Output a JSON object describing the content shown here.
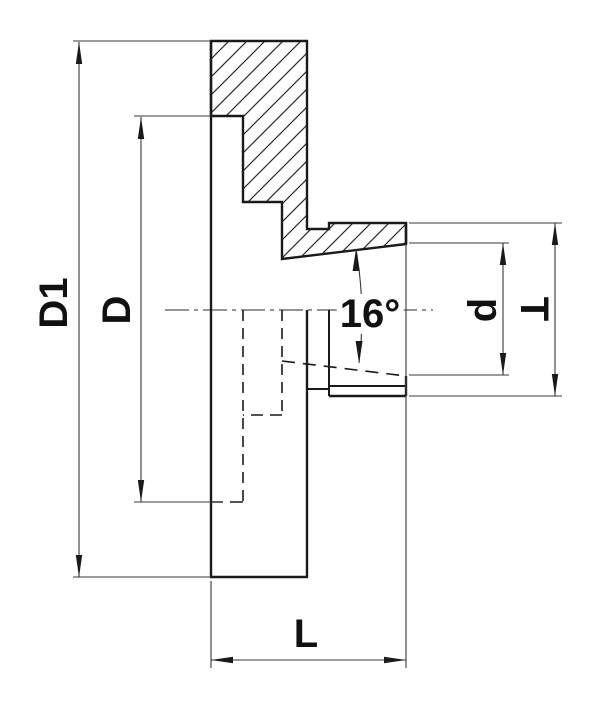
{
  "drawing": {
    "type": "technical-cross-section",
    "description": "flange adapter cross-section with tapered bore",
    "background": "#ffffff",
    "outline_color": "#1a1a1a",
    "dimension_line_color": "#3a3a3a",
    "dimensions": {
      "outer_diameter": {
        "label": "D1",
        "orientation": "vertical"
      },
      "recess_diameter": {
        "label": "D",
        "orientation": "vertical"
      },
      "taper_angle": {
        "label": "16°",
        "orientation": "horizontal"
      },
      "bore_diameter": {
        "label": "d",
        "orientation": "vertical"
      },
      "hub_diameter": {
        "label": "T",
        "orientation": "vertical"
      },
      "length": {
        "label": "L",
        "orientation": "horizontal"
      }
    }
  }
}
